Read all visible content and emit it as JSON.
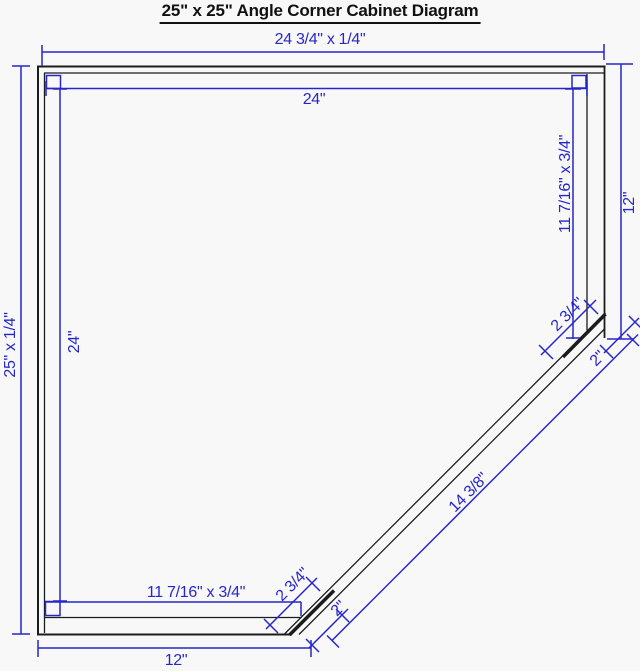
{
  "title": "25\" x 25\" Angle Corner Cabinet Diagram",
  "diagram_type": "cabinet plan view",
  "colors": {
    "outline": "#1c1c1c",
    "dimension": "#2626cc",
    "background": "#f8f8f8"
  },
  "dims": {
    "top_back_panel": "24 3/4\" x 1/4\"",
    "inner_width": "24\"",
    "left_back_panel": "25\" x 1/4\"",
    "inner_height": "24\"",
    "right_side_panel": "11 7/16\" x 3/4\"",
    "right_depth": "12\"",
    "bottom_side_panel": "11 7/16\" x 3/4\"",
    "bottom_width": "12\"",
    "angled_front_opening": "14 3/8\"",
    "front_stile_top": "2 3/4\"",
    "front_stile_bottom": "2 3/4\"",
    "end_cap_top": "2\"",
    "end_cap_bottom": "2\""
  }
}
